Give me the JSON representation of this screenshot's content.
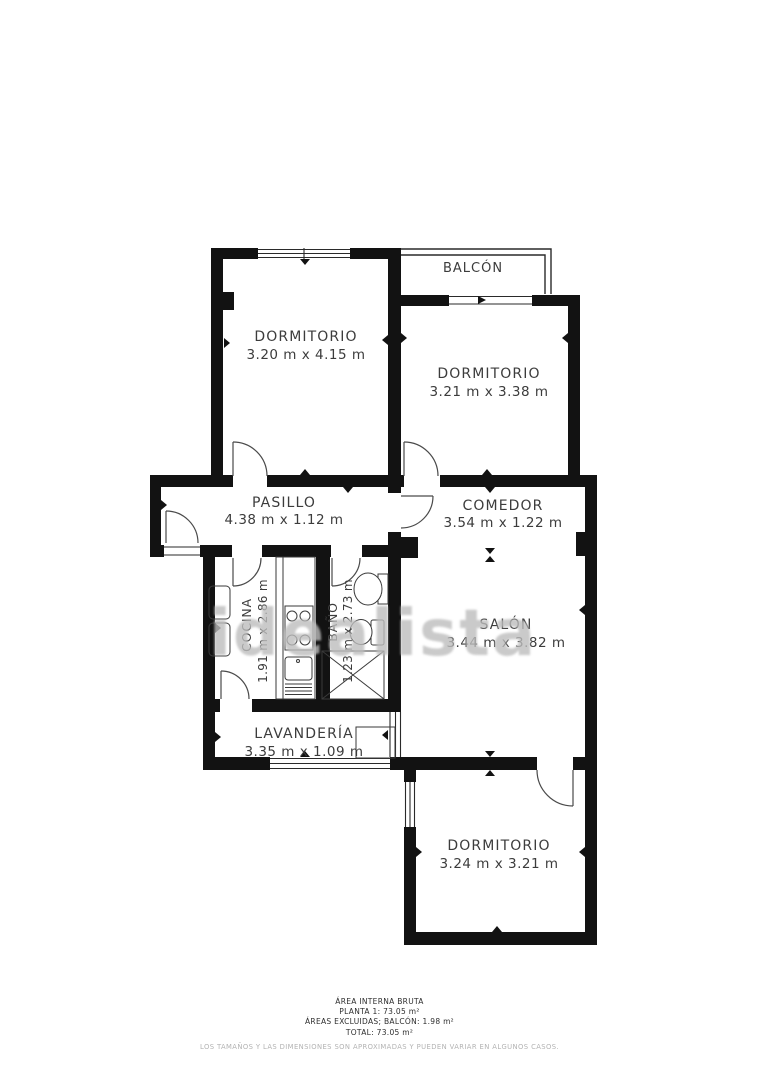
{
  "plan": {
    "watermark": "idealista",
    "balcony": {
      "name": "BALCÓN"
    },
    "rooms": [
      {
        "id": "dormitorio-1",
        "name": "DORMITORIO",
        "dims": "3.20 m x 4.15 m"
      },
      {
        "id": "dormitorio-2",
        "name": "DORMITORIO",
        "dims": "3.21 m x 3.38 m"
      },
      {
        "id": "pasillo",
        "name": "PASILLO",
        "dims": "4.38 m x 1.12 m"
      },
      {
        "id": "comedor",
        "name": "COMEDOR",
        "dims": "3.54 m x 1.22 m"
      },
      {
        "id": "cocina",
        "name": "COCINA",
        "dims": "1.91 m x 2.86 m"
      },
      {
        "id": "bano",
        "name": "BAÑO",
        "dims": "1.23 m x 2.73 m"
      },
      {
        "id": "salon",
        "name": "SALÓN",
        "dims": "3.44 m x 3.82 m"
      },
      {
        "id": "lavanderia",
        "name": "LAVANDERÍA",
        "dims": "3.35 m x 1.09 m"
      },
      {
        "id": "dormitorio-3",
        "name": "DORMITORIO",
        "dims": "3.24 m x 3.21 m"
      }
    ]
  },
  "footer": {
    "line1": "ÁREA INTERNA BRUTA",
    "line2": "PLANTA 1: 73.05 m²",
    "line3": "ÁREAS EXCLUIDAS; BALCÓN: 1.98 m²",
    "line4": "TOTAL: 73.05 m²",
    "disclaimer": "LOS TAMAÑOS Y LAS DIMENSIONES SON APROXIMADAS Y PUEDEN VARIAR EN ALGUNOS CASOS."
  },
  "colors": {
    "wall": "#121212",
    "label": "#3c3c3c",
    "watermark": "#bdbdbd",
    "background": "#ffffff"
  }
}
